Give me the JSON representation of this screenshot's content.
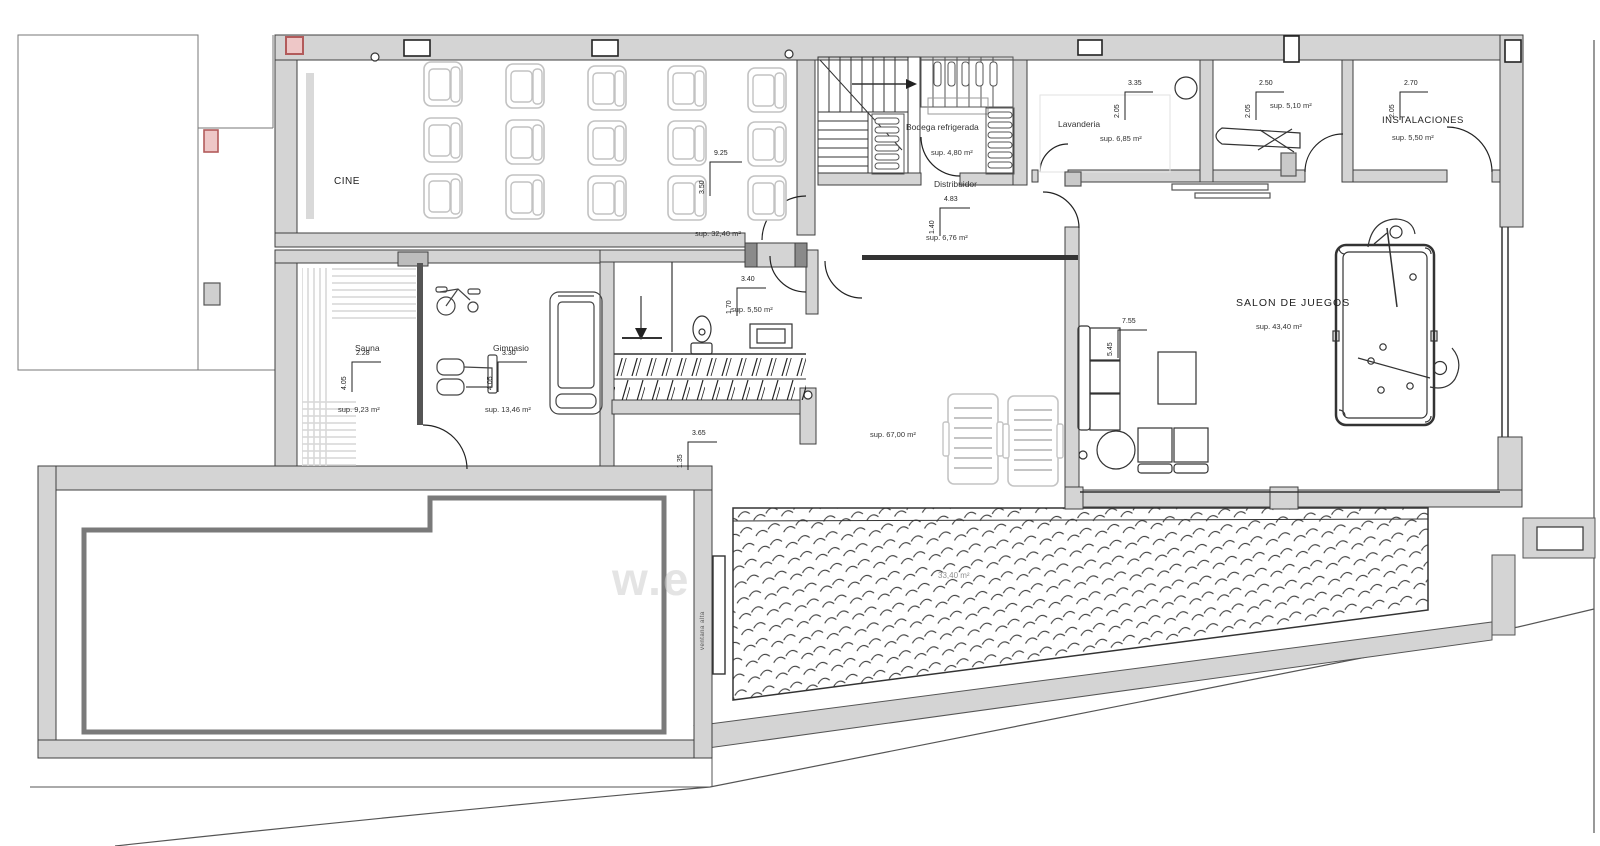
{
  "drawing": {
    "type": "floor-plan",
    "watermark": "w.e",
    "pool_area_label": "33,40 m²",
    "window_note": "ventana alta"
  },
  "rooms": {
    "cine": {
      "name": "CINE",
      "area": "sup. 32,40 m²",
      "dim_w": "9.25",
      "dim_h": "3.50"
    },
    "bodega": {
      "name": "Bodega refrigerada",
      "area": "sup. 4,80 m²"
    },
    "distribuidor": {
      "name": "Distribuidor",
      "area": "sup. 6,76 m²",
      "dim_w": "4.83",
      "dim_h": "1.40"
    },
    "lavanderia": {
      "name": "Lavanderia",
      "area": "sup. 6,85 m²",
      "dim_w": "3.35",
      "dim_h": "2.05"
    },
    "plancha": {
      "area": "sup. 5,10 m²",
      "dim_w": "2.50",
      "dim_h": "2.05"
    },
    "instalaciones": {
      "name": "INSTALACIONES",
      "area": "sup. 5,50 m²",
      "dim_w": "2.70",
      "dim_h": "2.05"
    },
    "aseo": {
      "area": "sup. 5,50 m²",
      "dim_w": "3.40",
      "dim_h": "1.70"
    },
    "sauna": {
      "name": "Sauna",
      "area": "sup. 9,23 m²",
      "dim_w": "2.28",
      "dim_h": "4.05"
    },
    "gimnasio": {
      "name": "Gimnasio",
      "area": "sup. 13,46 m²",
      "dim_w": "3.30",
      "dim_h": "4.05"
    },
    "salon": {
      "name": "SALON DE JUEGOS",
      "area": "sup. 43,40 m²",
      "dim_w": "7.55",
      "dim_h": "5.45"
    },
    "terraza": {
      "area": "sup. 67,00 m²",
      "dim_w": "3.65",
      "dim_h": "1.35"
    }
  },
  "colors": {
    "wall": "#d4d4d4",
    "line": "#3a3a3a",
    "red_accent": "#b25b5b",
    "light_furniture": "#c4c4c4"
  }
}
